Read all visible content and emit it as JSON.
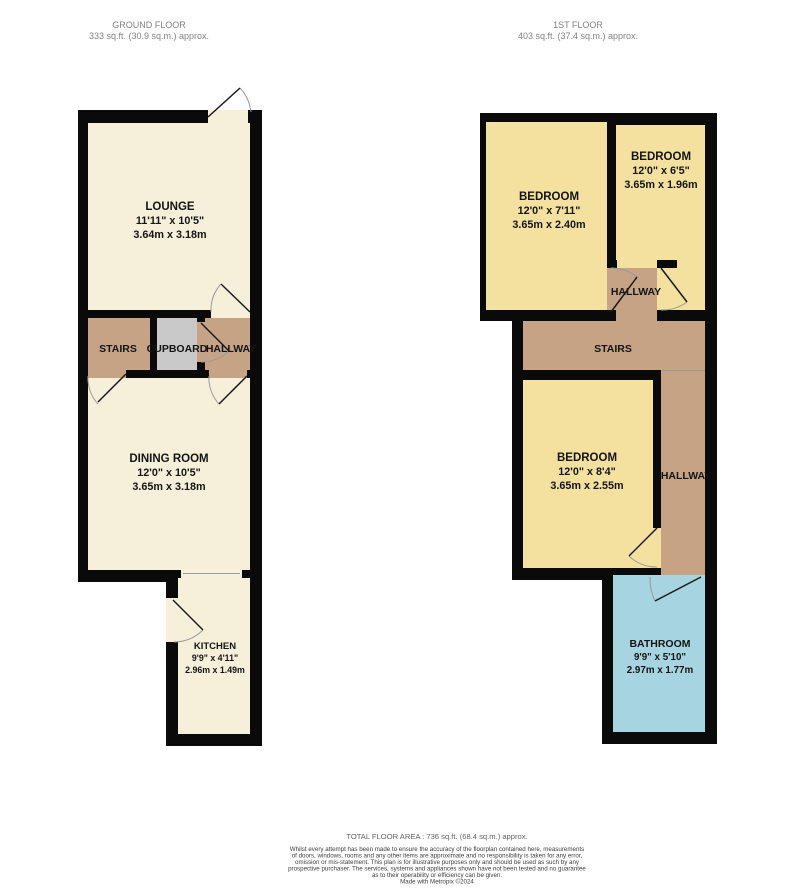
{
  "ground_floor": {
    "title": "GROUND FLOOR",
    "area": "333 sq.ft. (30.9 sq.m.) approx.",
    "rooms": {
      "lounge": {
        "name": "LOUNGE",
        "imperial": "11'11\" x 10'5\"",
        "metric": "3.64m x 3.18m"
      },
      "dining": {
        "name": "DINING ROOM",
        "imperial": "12'0\" x 10'5\"",
        "metric": "3.65m x 3.18m"
      },
      "kitchen": {
        "name": "KITCHEN",
        "imperial": "9'9\" x 4'11\"",
        "metric": "2.96m x 1.49m"
      },
      "stairs": {
        "name": "STAIRS"
      },
      "cupboard": {
        "name": "CUPBOARD"
      },
      "hallway": {
        "name": "HALLWAY"
      }
    }
  },
  "first_floor": {
    "title": "1ST FLOOR",
    "area": "403 sq.ft. (37.4 sq.m.) approx.",
    "rooms": {
      "bedroom_front": {
        "name": "BEDROOM",
        "imperial": "12'0\" x 6'5\"",
        "metric": "3.65m x 1.96m"
      },
      "bedroom_middle": {
        "name": "BEDROOM",
        "imperial": "12'0\" x 7'11\"",
        "metric": "3.65m x 2.40m"
      },
      "bedroom_back": {
        "name": "BEDROOM",
        "imperial": "12'0\" x 8'4\"",
        "metric": "3.65m x 2.55m"
      },
      "bathroom": {
        "name": "BATHROOM",
        "imperial": "9'9\" x 5'10\"",
        "metric": "2.97m x 1.77m"
      },
      "hallway_landing": {
        "name": "HALLWAY"
      },
      "hallway_side": {
        "name": "HALLWAY"
      },
      "stairs": {
        "name": "STAIRS"
      }
    }
  },
  "footer": {
    "total": "TOTAL FLOOR AREA : 736 sq.ft. (68.4 sq.m.) approx.",
    "disclaimer": [
      "Whilst every attempt has been made to ensure the accuracy of the floorplan contained here, measurements",
      "of doors, windows, rooms and any other items are approximate and no responsibility is taken for any error,",
      "omission or mis-statement. This plan is for illustrative purposes only and should be used as such by any",
      "prospective purchaser. The services, systems and appliances shown have not been tested and no guarantee",
      "as to their operability or efficiency can be given."
    ],
    "credit": "Made with Metropix ©2024"
  },
  "colors": {
    "wall": "#0a0a0a",
    "room_cream": "#f6f0da",
    "room_yellow": "#f4e1a0",
    "room_tan": "#c5a384",
    "room_gray": "#c9c9c9",
    "room_blue": "#a7d4e1"
  }
}
